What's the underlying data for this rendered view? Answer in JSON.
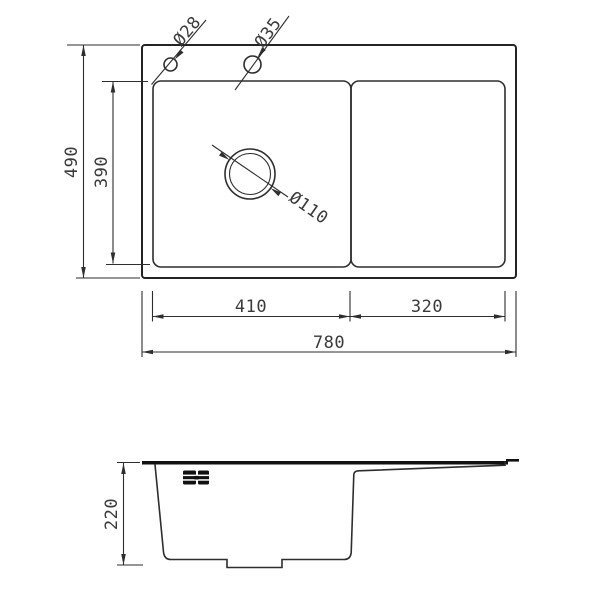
{
  "drawing": {
    "subject": "kitchen sink with drainboard - dimensioned technical drawing",
    "views": {
      "top_view_name": "top view",
      "side_view_name": "side profile view"
    },
    "colors": {
      "background": "#ffffff",
      "line": "#2e2e2e",
      "rim": "#111111",
      "text": "#3a3a3a"
    },
    "icons": {
      "faucet-holes-icon": "two striped black blocks with center dot (deck holes symbol)"
    },
    "top_view": {
      "dim_overall_width": "780",
      "dim_overall_depth": "490",
      "dim_bowl_inner_depth": "390",
      "dim_bowl_width": "410",
      "dim_drainboard_width": "320",
      "label_faucet_hole_small": "Ø28",
      "label_faucet_hole_large": "Ø35",
      "label_drain_diameter": "Ø110"
    },
    "side_view": {
      "dim_height": "220"
    }
  }
}
